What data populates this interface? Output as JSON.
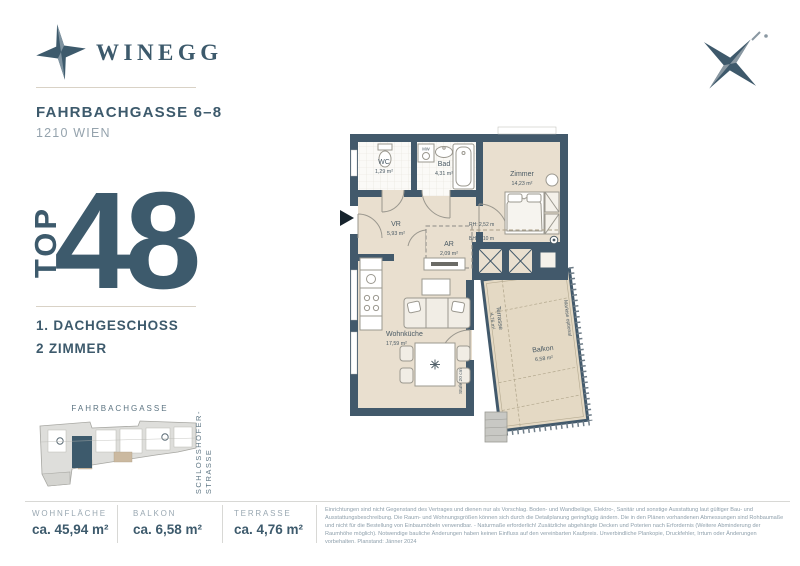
{
  "brand": {
    "name": "WINEGG"
  },
  "header": {
    "street": "FAHRBACHGASSE 6–8",
    "city": "1210 WIEN"
  },
  "unit": {
    "label": "TOP",
    "number": "48",
    "floor": "1. DACHGESCHOSS",
    "rooms": "2 ZIMMER"
  },
  "floor_plan": {
    "rooms": [
      {
        "name": "WC",
        "area": "1,29 m²"
      },
      {
        "name": "Bad",
        "area": "4,31 m²"
      },
      {
        "name": "Zimmer",
        "area": "14,23 m²"
      },
      {
        "name": "VR",
        "area": "5,93 m²"
      },
      {
        "name": "AR",
        "area": "2,09 m²"
      },
      {
        "name": "Wohnküche",
        "area": "17,59 m²"
      },
      {
        "name": "Balkon",
        "area": "6,58 m²"
      },
      {
        "name": "Terrasse",
        "area": "4,76 m²"
      }
    ],
    "annotations": {
      "mw": "MW",
      "room_height": "RH: 2,52 m",
      "parapet_height": "BH: 2,10 m",
      "step": "Stufe 20 cm",
      "awning": "Markise optional"
    }
  },
  "site_plan": {
    "street_top": "FAHRBACHGASSE",
    "street_right": "SCHLOSSHOFER-\nSTRASSE"
  },
  "stats": [
    {
      "label": "WOHNFLÄCHE",
      "value": "ca. 45,94 m²"
    },
    {
      "label": "BALKON",
      "value": "ca. 6,58 m²"
    },
    {
      "label": "TERRASSE",
      "value": "ca. 4,76 m²"
    }
  ],
  "disclaimer": "Einrichtungen sind nicht Gegenstand des Vertrages und dienen nur als Vorschlag. Boden- und Wandbeläge, Elektro-, Sanitär und sonstige Ausstattung laut gültiger Bau- und Ausstattungsbeschreibung. Die Raum- und Wohnungsgrößen können sich durch die Detailplanung geringfügig ändern. Die in den Plänen vorhandenen Abmessungen sind Rohbaumaße und nicht für die Bestellung von Einbaumöbeln verwendbar. - Naturmaße erforderlich! Zusätzliche abgehängte Decken und Poterien nach Erfordernis (Weitere Abminderung der Raumhöhe möglich). Notwendige bauliche Änderungen haben keinen Einfluss auf den vereinbarten Kaufpreis. Unverbindliche Plankopie, Druckfehler, Irrtum oder Änderungen vorbehalten. Planstand: Jänner 2024",
  "colors": {
    "brand": "#3d5a6c",
    "wall": "#42596b",
    "floor": "#e9dfcf",
    "muted": "#95a3ad"
  }
}
